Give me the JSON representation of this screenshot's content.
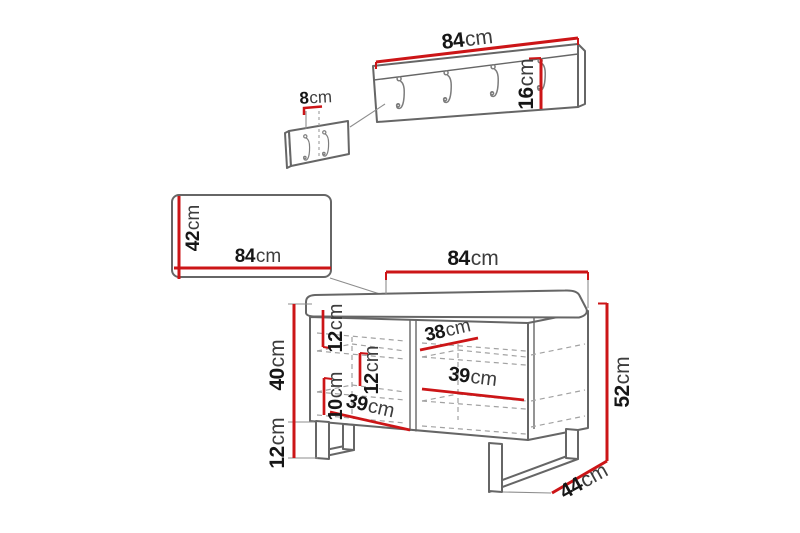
{
  "colors": {
    "background": "#ffffff",
    "dimension_red": "#cc1517",
    "outline_gray": "#666666",
    "dash_gray": "#a2a2a2",
    "number_color": "#161616",
    "unit_color": "#3d3d3d"
  },
  "unit": "cm",
  "icons": {
    "coat_hook_icon": "j-shaped-wall-hook"
  },
  "coat_rack": {
    "hook_count": 4,
    "width": {
      "num": "84",
      "unit": "cm"
    },
    "height": {
      "num": "16",
      "unit": "cm"
    },
    "hook_spacing": {
      "num": "8",
      "unit": "cm"
    }
  },
  "wall_panel": {
    "width": {
      "num": "84",
      "unit": "cm"
    },
    "height": {
      "num": "42",
      "unit": "cm"
    }
  },
  "bench": {
    "width": {
      "num": "84",
      "unit": "cm"
    },
    "total_height": {
      "num": "52",
      "unit": "cm"
    },
    "body_height": {
      "num": "40",
      "unit": "cm"
    },
    "leg_height": {
      "num": "12",
      "unit": "cm"
    },
    "depth": {
      "num": "44",
      "unit": "cm"
    },
    "top_gap": {
      "num": "12",
      "unit": "cm"
    },
    "middle_gap": {
      "num": "12",
      "unit": "cm"
    },
    "bottom_gap": {
      "num": "10",
      "unit": "cm"
    },
    "top_shelf_width": {
      "num": "38",
      "unit": "cm"
    },
    "middle_shelf_width": {
      "num": "39",
      "unit": "cm"
    },
    "bottom_shelf_width": {
      "num": "39",
      "unit": "cm"
    }
  }
}
